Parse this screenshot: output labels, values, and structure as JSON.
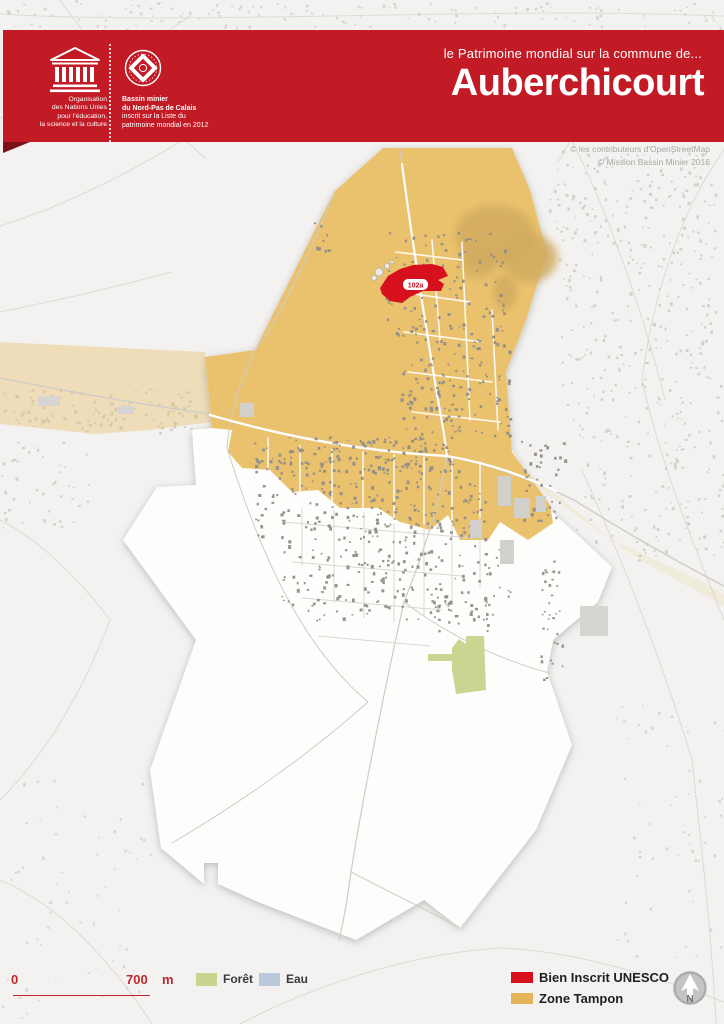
{
  "header": {
    "accent_color": "#c21b25",
    "unesco": {
      "org_lines": [
        "Organisation",
        "des Nations Unies",
        "pour l'éducation,",
        "la science et la culture"
      ]
    },
    "world_heritage": {
      "lines_bold": [
        "Bassin minier",
        "du Nord-Pas de Calais"
      ],
      "lines": [
        "inscrit sur la Liste du",
        "patrimoine mondial en 2012"
      ]
    },
    "subtitle": "le Patrimoine mondial sur la commune de...",
    "title": "Auberchicourt"
  },
  "map": {
    "copyright": [
      "© les contributeurs d'OpenStreetMap",
      "© Mission Bassin Minier 2016"
    ],
    "site_label": "102a",
    "colors": {
      "background": "#f3f2f0",
      "commune": "#fdfdfc",
      "buffer_zone": "#eac26d",
      "inscribed": "#d6101c",
      "forest": "#cbd591",
      "water": "#b9c8da",
      "terril": "#d0aa5e"
    },
    "draw": [
      {
        "k": "path",
        "name": "road-outside",
        "d": "M0,14 C200,26 480,6 724,16",
        "c": "#dedcd8",
        "w": 1
      },
      {
        "k": "path",
        "name": "road-outside",
        "d": "M0,118 C60,96 130,58 190,16",
        "c": "#dcdad6",
        "w": 1
      },
      {
        "k": "path",
        "name": "road-outside",
        "d": "M0,226 C90,198 170,150 250,98",
        "c": "#dcdad6",
        "w": 1
      },
      {
        "k": "path",
        "name": "road-outside",
        "d": "M60,0 C95,50 150,110 205,158",
        "c": "#dcdad6",
        "w": 1
      },
      {
        "k": "path",
        "name": "road-outside",
        "d": "M0,312 C60,300 120,286 172,272",
        "c": "#dcdad6",
        "w": 1
      },
      {
        "k": "path",
        "name": "road-outside",
        "d": "M560,118 C600,190 640,300 665,400",
        "c": "#dcdad6",
        "w": 1
      },
      {
        "k": "path",
        "name": "road-outside",
        "d": "M724,150 C680,210 652,300 642,380",
        "c": "#dcdad6",
        "w": 1
      },
      {
        "k": "path",
        "name": "road-outside",
        "d": "M642,380 C662,470 700,560 724,620",
        "c": "#dcdad6",
        "w": 1
      },
      {
        "k": "path",
        "name": "road-outside",
        "d": "M582,470 C622,560 662,660 692,760",
        "c": "#dcdad6",
        "w": 1
      },
      {
        "k": "path",
        "name": "road-outside",
        "d": "M692,760 C702,850 712,940 716,1024",
        "c": "#dcdad6",
        "w": 1
      },
      {
        "k": "path",
        "name": "road-outside",
        "d": "M620,40 C598,88 578,130 558,162",
        "c": "#dcdad6",
        "w": 1
      },
      {
        "k": "path",
        "name": "road-outside",
        "d": "M0,880 C60,905 112,962 152,1024",
        "c": "#dcdad6",
        "w": 1
      },
      {
        "k": "path",
        "name": "road-outside",
        "d": "M240,1024 C320,982 420,952 502,948",
        "c": "#dcdad6",
        "w": 1
      },
      {
        "k": "path",
        "name": "road-outside",
        "d": "M502,948 C582,952 652,976 724,1002",
        "c": "#dcdad6",
        "w": 1
      },
      {
        "k": "path",
        "name": "road-outside",
        "d": "M0,520 C40,540 80,580 110,620",
        "c": "#dcdad6",
        "w": 1
      },
      {
        "k": "path",
        "name": "road-outside",
        "d": "M110,620 C80,700 40,760 0,800",
        "c": "#dcdad6",
        "w": 1
      },
      {
        "k": "cl",
        "name": "buildings-outside",
        "x": 140,
        "y": 2,
        "w": 300,
        "h": 26,
        "n": 55,
        "seed": 11,
        "f": "#cac8c5",
        "o": 0.7,
        "min": 1.4,
        "max": 2.8
      },
      {
        "k": "cl",
        "name": "buildings-outside",
        "x": 450,
        "y": 2,
        "w": 274,
        "h": 26,
        "n": 45,
        "seed": 12,
        "f": "#cac8c5",
        "o": 0.7,
        "min": 1.4,
        "max": 2.8
      },
      {
        "k": "cl",
        "name": "buildings-outside",
        "x": 0,
        "y": 0,
        "w": 140,
        "h": 30,
        "n": 28,
        "seed": 13,
        "f": "#cac8c5",
        "o": 0.7,
        "min": 1.4,
        "max": 2.8
      },
      {
        "k": "cl",
        "name": "buildings-outside",
        "x": 2,
        "y": 388,
        "w": 200,
        "h": 44,
        "n": 110,
        "seed": 14,
        "f": "#c7c5c2",
        "o": 0.8,
        "min": 1.6,
        "max": 3.2
      },
      {
        "k": "cl",
        "name": "buildings-outside",
        "x": 548,
        "y": 150,
        "w": 170,
        "h": 110,
        "n": 150,
        "seed": 15,
        "f": "#c7c5c2",
        "o": 0.75,
        "min": 1.5,
        "max": 3.0
      },
      {
        "k": "cl",
        "name": "buildings-outside",
        "x": 560,
        "y": 260,
        "w": 164,
        "h": 160,
        "n": 160,
        "seed": 16,
        "f": "#c7c5c2",
        "o": 0.75,
        "min": 1.5,
        "max": 3.0
      },
      {
        "k": "cl",
        "name": "buildings-outside",
        "x": 575,
        "y": 420,
        "w": 149,
        "h": 140,
        "n": 120,
        "seed": 17,
        "f": "#c7c5c2",
        "o": 0.75,
        "min": 1.5,
        "max": 3.0
      },
      {
        "k": "cl",
        "name": "buildings-outside",
        "x": 0,
        "y": 440,
        "w": 90,
        "h": 90,
        "n": 42,
        "seed": 18,
        "f": "#c7c5c2",
        "o": 0.75,
        "min": 1.5,
        "max": 3.0
      },
      {
        "k": "cl",
        "name": "buildings-outside",
        "x": 0,
        "y": 780,
        "w": 150,
        "h": 240,
        "n": 60,
        "seed": 19,
        "f": "#ccc9c6",
        "o": 0.7,
        "min": 1.4,
        "max": 2.8
      },
      {
        "k": "cl",
        "name": "buildings-outside",
        "x": 610,
        "y": 700,
        "w": 114,
        "h": 260,
        "n": 55,
        "seed": 20,
        "f": "#ccc9c6",
        "o": 0.7,
        "min": 1.4,
        "max": 2.8
      },
      {
        "k": "poly",
        "name": "buffer-zone-faded-west",
        "p": "0,342 205,352 212,422 150,430 95,434 0,424",
        "f": "#eac26d",
        "o": 0.42
      },
      {
        "k": "poly",
        "name": "commune-boundary",
        "cls": "shadow",
        "f": "#fdfdfc",
        "o": 1,
        "p": "383,148 512,148 530,190 547,253 526,320 506,372 512,450 545,505 612,567 598,602 553,640 547,672 572,745 536,830 460,928 424,900 356,940 258,902 218,884 218,863 204,863 204,884 161,848 150,770 196,640 123,540 157,487 196,485 192,430 212,428 205,357 255,350 334,192"
      },
      {
        "k": "poly",
        "name": "buffer-zone",
        "f": "#eac26d",
        "o": 1,
        "p": "383,148 512,148 530,190 547,253 526,320 506,372 512,452 550,505 553,523 528,540 500,522 488,540 460,540 448,515 430,530 400,522 378,508 340,508 318,490 292,492 270,470 242,468 228,452 232,430 212,428 205,357 255,350 334,192"
      },
      {
        "k": "poly",
        "name": "buffer-zone-faded-east",
        "p": "510,456 612,540 700,580 724,594 724,606 640,560 515,472",
        "f": "#eac26d",
        "o": 0.15
      },
      {
        "k": "ellipse",
        "name": "terril-wooded",
        "cls": "soft",
        "cx": 495,
        "cy": 235,
        "rx": 40,
        "ry": 30,
        "f": "#d0aa5e",
        "o": 0.8
      },
      {
        "k": "ellipse",
        "name": "terril-wooded",
        "cls": "soft",
        "cx": 530,
        "cy": 258,
        "rx": 28,
        "ry": 24,
        "f": "#d0aa5e",
        "o": 0.8
      },
      {
        "k": "ellipse",
        "name": "terril-wooded",
        "cls": "soft",
        "cx": 478,
        "cy": 262,
        "rx": 18,
        "ry": 16,
        "f": "#d0aa5e",
        "o": 0.8
      },
      {
        "k": "ellipse",
        "name": "terril-wooded",
        "cls": "soft",
        "cx": 505,
        "cy": 292,
        "rx": 12,
        "ry": 18,
        "f": "#d0aa5e",
        "o": 0.8
      },
      {
        "k": "path",
        "name": "road-main",
        "d": "M0,378 C70,392 140,404 203,413",
        "c": "#cfccc8",
        "w": 1.4
      },
      {
        "k": "path",
        "name": "road-main",
        "d": "M203,413 C290,438 370,451 447,456 C498,466 540,484 574,500 C628,534 678,562 724,586",
        "c": "#cfccc8",
        "w": 1.4
      },
      {
        "k": "path",
        "name": "road-ns",
        "d": "M400,150 C410,230 426,332 436,392 C442,426 446,446 447,456 C440,500 424,552 404,602 C386,682 363,796 351,872 C347,902 343,924 339,940",
        "c": "#cfccc8",
        "w": 1.2
      },
      {
        "k": "path",
        "name": "road-field",
        "d": "M334,194 C304,268 272,330 254,352 C241,380 229,416 227,448",
        "c": "#cfccc8",
        "w": 1
      },
      {
        "k": "path",
        "name": "road-field",
        "d": "M404,602 C452,638 502,660 549,673",
        "c": "#cfccc8",
        "w": 1
      },
      {
        "k": "path",
        "name": "road-field",
        "d": "M351,872 C392,893 432,913 459,927",
        "c": "#cfccc8",
        "w": 1
      },
      {
        "k": "path",
        "name": "road-field",
        "d": "M368,702 C312,752 242,802 172,843",
        "c": "#cfccc8",
        "w": 1
      },
      {
        "k": "path",
        "name": "road-field",
        "d": "M227,448 C262,560 304,648 368,702",
        "c": "#cfccc8",
        "w": 1
      },
      {
        "k": "path",
        "name": "road-white",
        "d": "M210,415 C292,439 372,452 447,456 C494,464 528,478 556,491",
        "c": "#ffffff",
        "w": 2.4,
        "o": 0.95
      },
      {
        "k": "path",
        "name": "road-white",
        "d": "M402,164 C412,240 428,340 437,394 C443,427 446,447 447,456",
        "c": "#ffffff",
        "w": 2.2,
        "o": 0.95
      },
      {
        "k": "path",
        "name": "street",
        "d": "M300,446 L300,506",
        "c": "#ffffff",
        "w": 1.5,
        "o": 0.92
      },
      {
        "k": "path",
        "name": "street",
        "d": "M332,450 L332,508",
        "c": "#ffffff",
        "w": 1.5,
        "o": 0.92
      },
      {
        "k": "path",
        "name": "street",
        "d": "M363,452 L363,510",
        "c": "#ffffff",
        "w": 1.5,
        "o": 0.92
      },
      {
        "k": "path",
        "name": "street",
        "d": "M394,455 L394,522",
        "c": "#ffffff",
        "w": 1.5,
        "o": 0.92
      },
      {
        "k": "path",
        "name": "street",
        "d": "M424,457 L424,524",
        "c": "#ffffff",
        "w": 1.5,
        "o": 0.92
      },
      {
        "k": "path",
        "name": "street",
        "d": "M452,458 L452,520",
        "c": "#ffffff",
        "w": 1.5,
        "o": 0.92
      },
      {
        "k": "path",
        "name": "street",
        "d": "M480,462 L480,518",
        "c": "#ffffff",
        "w": 1.5,
        "o": 0.92
      },
      {
        "k": "path",
        "name": "street",
        "d": "M268,438 L268,472",
        "c": "#ffffff",
        "w": 1.5,
        "o": 0.92
      },
      {
        "k": "path",
        "name": "street",
        "d": "M396,252 L462,260",
        "c": "#ffffff",
        "w": 1.5,
        "o": 0.92
      },
      {
        "k": "path",
        "name": "street",
        "d": "M400,292 L470,302",
        "c": "#ffffff",
        "w": 1.5,
        "o": 0.92
      },
      {
        "k": "path",
        "name": "street",
        "d": "M404,332 L482,342",
        "c": "#ffffff",
        "w": 1.5,
        "o": 0.92
      },
      {
        "k": "path",
        "name": "street",
        "d": "M408,372 L492,382",
        "c": "#ffffff",
        "w": 1.5,
        "o": 0.92
      },
      {
        "k": "path",
        "name": "street",
        "d": "M412,412 L500,422",
        "c": "#ffffff",
        "w": 1.5,
        "o": 0.92
      },
      {
        "k": "path",
        "name": "street",
        "d": "M432,240 L440,340",
        "c": "#ffffff",
        "w": 1.5,
        "o": 0.92
      },
      {
        "k": "path",
        "name": "street",
        "d": "M462,242 L470,420",
        "c": "#ffffff",
        "w": 1.5,
        "o": 0.92
      },
      {
        "k": "path",
        "name": "street",
        "d": "M492,310 L498,430",
        "c": "#ffffff",
        "w": 1.5,
        "o": 0.92
      },
      {
        "k": "path",
        "name": "street",
        "d": "M302,508 L302,565",
        "c": "#d8d6d2",
        "w": 1
      },
      {
        "k": "path",
        "name": "street",
        "d": "M334,510 L334,602",
        "c": "#d8d6d2",
        "w": 1
      },
      {
        "k": "path",
        "name": "street",
        "d": "M364,512 L364,618",
        "c": "#d8d6d2",
        "w": 1
      },
      {
        "k": "path",
        "name": "street",
        "d": "M394,524 L394,622",
        "c": "#d8d6d2",
        "w": 1
      },
      {
        "k": "path",
        "name": "street",
        "d": "M424,526 L424,615",
        "c": "#d8d6d2",
        "w": 1
      },
      {
        "k": "path",
        "name": "street",
        "d": "M452,522 L452,602",
        "c": "#d8d6d2",
        "w": 1
      },
      {
        "k": "path",
        "name": "street",
        "d": "M480,520 L480,588",
        "c": "#d8d6d2",
        "w": 1
      },
      {
        "k": "path",
        "name": "street",
        "d": "M282,522 L472,538",
        "c": "#d8d6d2",
        "w": 1
      },
      {
        "k": "path",
        "name": "street",
        "d": "M292,562 L462,576",
        "c": "#d8d6d2",
        "w": 1
      },
      {
        "k": "path",
        "name": "street",
        "d": "M302,598 L442,610",
        "c": "#d8d6d2",
        "w": 1
      },
      {
        "k": "path",
        "name": "street",
        "d": "M318,636 L430,646",
        "c": "#d8d6d2",
        "w": 1
      },
      {
        "k": "cl",
        "name": "buildings-town",
        "x": 252,
        "y": 436,
        "w": 200,
        "h": 34,
        "n": 150,
        "seed": 1,
        "f": "#918e89",
        "o": 0.95,
        "min": 1.6,
        "max": 3.2
      },
      {
        "k": "cl",
        "name": "buildings-town",
        "x": 255,
        "y": 470,
        "w": 230,
        "h": 70,
        "n": 200,
        "seed": 2,
        "f": "#918e89",
        "o": 0.95,
        "min": 1.6,
        "max": 3.2
      },
      {
        "k": "cl",
        "name": "buildings-town",
        "x": 280,
        "y": 540,
        "w": 230,
        "h": 80,
        "n": 180,
        "seed": 3,
        "f": "#918e89",
        "o": 0.95,
        "min": 1.6,
        "max": 3.2
      },
      {
        "k": "cl",
        "name": "buildings-town",
        "x": 385,
        "y": 230,
        "w": 120,
        "h": 120,
        "n": 130,
        "seed": 4,
        "f": "#918e89",
        "o": 0.95,
        "min": 1.6,
        "max": 3.2
      },
      {
        "k": "cl",
        "name": "buildings-town",
        "x": 400,
        "y": 350,
        "w": 110,
        "h": 90,
        "n": 110,
        "seed": 5,
        "f": "#918e89",
        "o": 0.95,
        "min": 1.6,
        "max": 3.2
      },
      {
        "k": "cl",
        "name": "buildings-town",
        "x": 310,
        "y": 222,
        "w": 26,
        "h": 30,
        "n": 9,
        "seed": 6,
        "f": "#918e89",
        "o": 0.95,
        "min": 1.6,
        "max": 3.0
      },
      {
        "k": "cl",
        "name": "buildings-town",
        "x": 520,
        "y": 440,
        "w": 45,
        "h": 80,
        "n": 40,
        "seed": 7,
        "f": "#918e89",
        "o": 0.95,
        "min": 1.6,
        "max": 3.2
      },
      {
        "k": "cl",
        "name": "buildings-town",
        "x": 430,
        "y": 600,
        "w": 60,
        "h": 30,
        "n": 24,
        "seed": 8,
        "f": "#918e89",
        "o": 0.95,
        "min": 1.6,
        "max": 3.0
      },
      {
        "k": "cl",
        "name": "buildings-town",
        "x": 540,
        "y": 560,
        "w": 22,
        "h": 120,
        "n": 35,
        "seed": 9,
        "f": "#918e89",
        "o": 0.9,
        "min": 1.4,
        "max": 2.8
      },
      {
        "k": "rect",
        "name": "industrial-building",
        "x": 498,
        "y": 476,
        "w": 13,
        "h": 30,
        "f": "#d2d0cd"
      },
      {
        "k": "rect",
        "name": "industrial-building",
        "x": 514,
        "y": 498,
        "w": 16,
        "h": 20,
        "f": "#d2d0cd"
      },
      {
        "k": "rect",
        "name": "industrial-building",
        "x": 536,
        "y": 496,
        "w": 10,
        "h": 16,
        "f": "#d2d0cd"
      },
      {
        "k": "rect",
        "name": "industrial-building",
        "x": 470,
        "y": 520,
        "w": 12,
        "h": 18,
        "f": "#d2d0cd"
      },
      {
        "k": "rect",
        "name": "industrial-building",
        "x": 500,
        "y": 540,
        "w": 14,
        "h": 24,
        "f": "#d2d0cd"
      },
      {
        "k": "rect",
        "name": "industrial-building",
        "x": 240,
        "y": 403,
        "w": 14,
        "h": 14,
        "f": "#d2d0cd"
      },
      {
        "k": "rect",
        "name": "industrial-building",
        "x": 580,
        "y": 606,
        "w": 28,
        "h": 30,
        "f": "#d7d5d2"
      },
      {
        "k": "rect",
        "name": "industrial-building",
        "x": 38,
        "y": 396,
        "w": 22,
        "h": 10,
        "f": "#d7d5d2"
      },
      {
        "k": "rect",
        "name": "industrial-building",
        "x": 118,
        "y": 406,
        "w": 16,
        "h": 8,
        "f": "#d7d5d2"
      },
      {
        "k": "poly",
        "name": "forest-area",
        "p": "452,648 459,639 466,644 466,636 484,636 486,690 456,694 452,670",
        "f": "#cbd591",
        "o": 1
      },
      {
        "k": "poly",
        "name": "forest-area",
        "p": "428,654 452,654 452,661 428,661",
        "f": "#cbd591",
        "o": 1
      },
      {
        "k": "circle",
        "name": "tank",
        "cx": 379,
        "cy": 272,
        "r": 4,
        "f": "#edebe8",
        "s": "#b3b1ae",
        "sw": 0.8
      },
      {
        "k": "circle",
        "name": "tank",
        "cx": 387,
        "cy": 266,
        "r": 2.6,
        "f": "#edebe8",
        "s": "#b3b1ae",
        "sw": 0.8
      },
      {
        "k": "circle",
        "name": "tank",
        "cx": 374,
        "cy": 278,
        "r": 2.6,
        "f": "#edebe8",
        "s": "#b3b1ae",
        "sw": 0.8
      },
      {
        "k": "circle",
        "name": "tank",
        "cx": 392,
        "cy": 262,
        "r": 1.8,
        "f": "#edebe8",
        "s": "#b3b1ae",
        "sw": 0.8
      },
      {
        "k": "poly",
        "name": "inscribed-site",
        "f": "#d6101c",
        "o": 1,
        "p": "380,288 388,276 400,269 413,265 432,264 443,267 448,276 438,280 444,284 441,291 423,291 410,297 402,303 390,301 382,294"
      }
    ]
  },
  "legend": {
    "scale": {
      "start": "0",
      "end": "700",
      "unit": "m"
    },
    "items_left": [
      {
        "label": "Forêt",
        "color": "#c9d48e"
      },
      {
        "label": "Eau",
        "color": "#b9c8da"
      }
    ],
    "items_right": [
      {
        "label": "Bien Inscrit UNESCO",
        "color": "#d6101c"
      },
      {
        "label": "Zone Tampon",
        "color": "#e3b558"
      }
    ]
  },
  "north_label": "N"
}
